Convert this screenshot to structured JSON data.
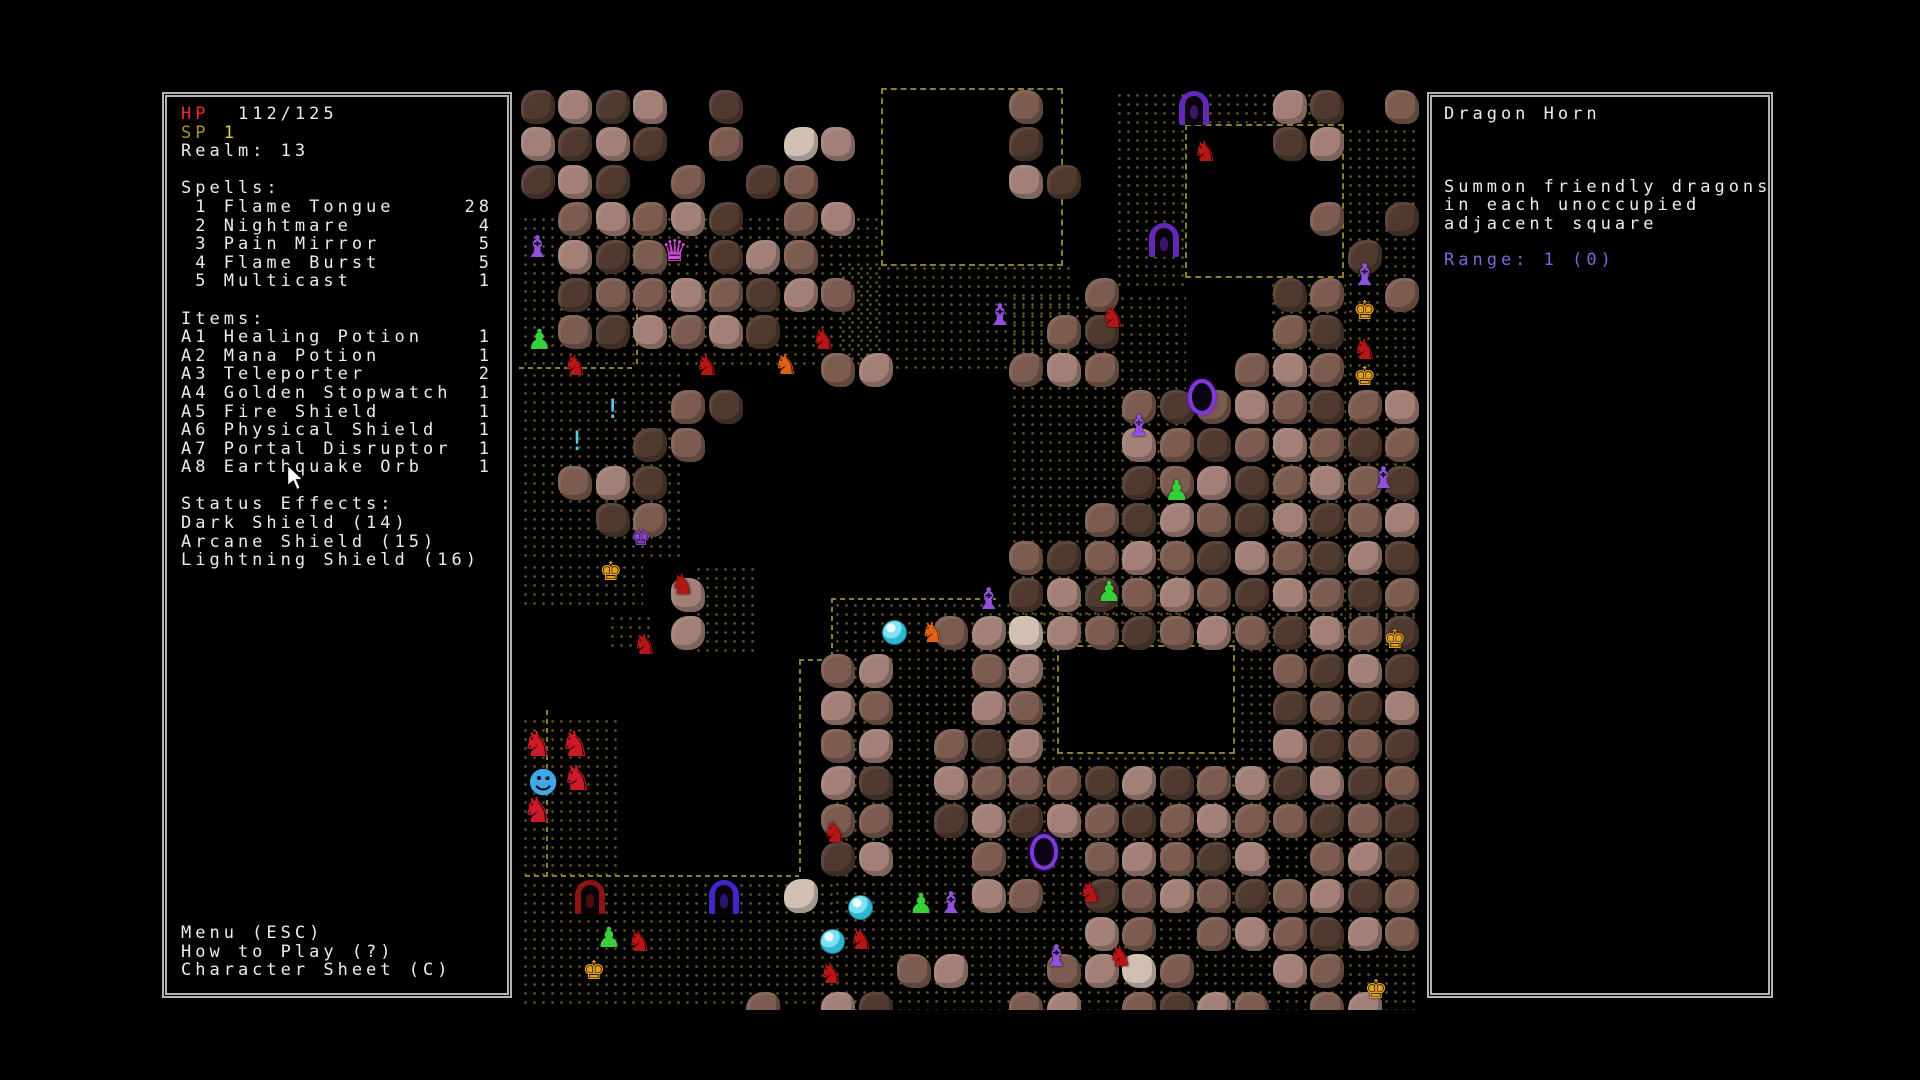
{
  "hud": {
    "hp_label": "HP",
    "hp_value": "112/125",
    "sp_label": "SP",
    "sp_value": "1",
    "realm_label": "Realm:",
    "realm_value": "13",
    "spells_header": "Spells:",
    "spells": [
      {
        "key": "1",
        "name": "Flame Tongue",
        "count": "28"
      },
      {
        "key": "2",
        "name": "Nightmare",
        "count": "4"
      },
      {
        "key": "3",
        "name": "Pain Mirror",
        "count": "5"
      },
      {
        "key": "4",
        "name": "Flame Burst",
        "count": "5"
      },
      {
        "key": "5",
        "name": "Multicast",
        "count": "1"
      }
    ],
    "items_header": "Items:",
    "items": [
      {
        "key": "A1",
        "name": "Healing Potion",
        "count": "1"
      },
      {
        "key": "A2",
        "name": "Mana Potion",
        "count": "1"
      },
      {
        "key": "A3",
        "name": "Teleporter",
        "count": "2"
      },
      {
        "key": "A4",
        "name": "Golden Stopwatch",
        "count": "1"
      },
      {
        "key": "A5",
        "name": "Fire Shield",
        "count": "1"
      },
      {
        "key": "A6",
        "name": "Physical Shield",
        "count": "1"
      },
      {
        "key": "A7",
        "name": "Portal Disruptor",
        "count": "1"
      },
      {
        "key": "A8",
        "name": "Earthquake Orb",
        "count": "1"
      }
    ],
    "status_header": "Status Effects:",
    "status_effects": [
      "Dark Shield (14)",
      "Arcane Shield (15)",
      "Lightning Shield (16)"
    ],
    "menu": [
      "Menu (ESC)",
      "How to Play (?)",
      "Character Sheet (C)"
    ]
  },
  "info_panel": {
    "title": "Dragon Horn",
    "description_lines": [
      "Summon friendly dragons",
      "in each unoccupied",
      "adjacent square"
    ],
    "range_text": "Range: 1 (0)"
  },
  "colors": {
    "hp": "#e83030",
    "sp_label": "#a89a20",
    "sp_value": "#ded040",
    "text": "#ececec",
    "panel_border": "#b4b4b4",
    "range_text": "#7e66d4",
    "floor_dots": "#6f6628",
    "wall_dash": "#8a7f2e"
  },
  "map": {
    "origin_x": 519,
    "origin_y": 88,
    "cell": 37.6,
    "rock_colors": {
      "1": "#503a30",
      "2": "#7c5c50",
      "3": "#a28078",
      "4": "#d0bfb2"
    },
    "grid": [
      "1313 1       2  ... 31 2",
      "3131 2 43    1  ... 13..",
      "131.2 12     31     ....",
      ".23231 23.          .2.1",
      ".312.132..          ..1.",
      ".12232132.. .. 2    12.2",
      ".213231.......21....21..",
      "........23...232...232..",
      "....21       ...21232123",
      "...12        ...32123212",
      ".231         ...12312321",
      "..12         ..213213123",
      ".....       .21232132131",
      "....3       .13123213212",
      "....3   ...2343212321321",
      "        23..23      2131",
      "..      32..32      1213",
      "..      23.213      3121",
      "..      31.3222131231312",
      "..      22.1313212322121",
      ".....   13..2..23213.231",
      ".  .. .4....32.123212312",
      "...............32.232132",
      "..........23..2342..32..",
      "......2.31...23.2132.23."
    ],
    "floors": [
      [
        0,
        3.3,
        9.6,
        4.15
      ],
      [
        0,
        7.45,
        4.4,
        5.1
      ],
      [
        0,
        12.55,
        3.3,
        1.2
      ],
      [
        2.3,
        13.9,
        1.3,
        1.1
      ],
      [
        0,
        16.65,
        2.6,
        4.35
      ],
      [
        8.45,
        4.6,
        6.3,
        2.9
      ],
      [
        13,
        5.4,
        4.75,
        9.4
      ],
      [
        15.8,
        0,
        1.95,
        5.4
      ],
      [
        17.75,
        0,
        4.2,
        0.93
      ],
      [
        21.95,
        0.95,
        1.9,
        13.9
      ],
      [
        19.9,
        5.05,
        2.1,
        9.8
      ],
      [
        8.3,
        13.57,
        15.55,
        10.95
      ],
      [
        0,
        21,
        8.35,
        3.5
      ],
      [
        4.6,
        12.6,
        1.75,
        2.55
      ]
    ],
    "rooms": [
      [
        9.62,
        0,
        4.85,
        4.72
      ],
      [
        17.7,
        0.95,
        4.25,
        4.1
      ],
      [
        14.3,
        14.8,
        4.75,
        2.9
      ]
    ],
    "walls": [
      {
        "o": "h",
        "x": 0.15,
        "y": 20.93,
        "len": 7.3
      },
      {
        "o": "v",
        "x": 7.45,
        "y": 15.2,
        "len": 5.75
      },
      {
        "o": "h",
        "x": 7.45,
        "y": 15.18,
        "len": 0.9
      },
      {
        "o": "v",
        "x": 8.3,
        "y": 13.55,
        "len": 1.7
      },
      {
        "o": "h",
        "x": 8.3,
        "y": 13.55,
        "len": 4.4
      },
      {
        "o": "v",
        "x": 0.72,
        "y": 16.55,
        "len": 4.4
      },
      {
        "o": "h",
        "x": 0.0,
        "y": 7.42,
        "len": 3.1
      },
      {
        "o": "v",
        "x": 3.1,
        "y": 5.3,
        "len": 2.12
      }
    ],
    "doors": [
      {
        "c": 17.55,
        "r": 0.08,
        "kind": "purple"
      },
      {
        "c": 16.75,
        "r": 3.6,
        "kind": "purple"
      },
      {
        "c": 1.5,
        "r": 21.05,
        "kind": "red"
      },
      {
        "c": 5.05,
        "r": 21.05,
        "kind": "indigo"
      }
    ],
    "door_colors": {
      "purple": "#6428b8",
      "red": "#8c1414",
      "indigo": "#4028c8"
    },
    "rings": [
      [
        17.8,
        7.75
      ],
      [
        13.6,
        19.85
      ]
    ],
    "sprites": {
      "witch": {
        "glyph": "♝",
        "color": "#9050e0",
        "size": 30
      },
      "demon": {
        "glyph": "♛",
        "color": "#d848d8",
        "size": 30
      },
      "spider": {
        "glyph": "♟",
        "color": "#38d038",
        "size": 28
      },
      "fox": {
        "glyph": "♞",
        "color": "#b81616",
        "size": 28
      },
      "crab": {
        "glyph": "♞",
        "color": "#e06018",
        "size": 28
      },
      "dragon": {
        "glyph": "♞",
        "color": "#cc1a28",
        "size": 35
      },
      "player": {
        "glyph": "☻",
        "color": "#40a8e8",
        "size": 30
      },
      "imp": {
        "glyph": "♚",
        "color": "#e0a024",
        "size": 26
      },
      "impP": {
        "glyph": "♚",
        "color": "#9048d0",
        "size": 23
      },
      "potion": {
        "glyph": "!",
        "color": "#58c8e8",
        "size": 27
      }
    },
    "entities": [
      {
        "c": 0.0,
        "r": 3.75,
        "t": "witch"
      },
      {
        "c": 3.65,
        "r": 3.85,
        "t": "demon"
      },
      {
        "c": 12.3,
        "r": 5.55,
        "t": "witch"
      },
      {
        "c": 15.3,
        "r": 5.6,
        "t": "fox"
      },
      {
        "c": 17.75,
        "r": 1.2,
        "t": "fox"
      },
      {
        "c": 0.05,
        "r": 6.2,
        "t": "spider"
      },
      {
        "c": 1.0,
        "r": 6.9,
        "t": "fox"
      },
      {
        "c": 4.5,
        "r": 6.9,
        "t": "fox"
      },
      {
        "c": 6.6,
        "r": 6.85,
        "t": "crab"
      },
      {
        "c": 7.6,
        "r": 6.2,
        "t": "fox"
      },
      {
        "c": 2.0,
        "r": 8.05,
        "t": "potion"
      },
      {
        "c": 1.05,
        "r": 8.9,
        "t": "potion"
      },
      {
        "c": 16.0,
        "r": 8.5,
        "t": "witch"
      },
      {
        "c": 17.0,
        "r": 10.2,
        "t": "spider"
      },
      {
        "c": 22.0,
        "r": 4.5,
        "t": "witch"
      },
      {
        "c": 22.0,
        "r": 5.45,
        "t": "imp"
      },
      {
        "c": 22.0,
        "r": 6.45,
        "t": "fox"
      },
      {
        "c": 22.0,
        "r": 7.2,
        "t": "imp"
      },
      {
        "c": 22.5,
        "r": 9.9,
        "t": "witch"
      },
      {
        "c": 2.75,
        "r": 11.5,
        "t": "impP"
      },
      {
        "c": 1.95,
        "r": 12.4,
        "t": "imp"
      },
      {
        "c": 3.85,
        "r": 12.7,
        "t": "fox"
      },
      {
        "c": 12.0,
        "r": 13.1,
        "t": "witch"
      },
      {
        "c": 15.2,
        "r": 12.9,
        "t": "spider"
      },
      {
        "c": 9.5,
        "r": 14.0,
        "t": "bubble"
      },
      {
        "c": 10.5,
        "r": 14.0,
        "t": "crab"
      },
      {
        "c": 2.85,
        "r": 14.3,
        "t": "fox"
      },
      {
        "c": 22.8,
        "r": 14.2,
        "t": "imp"
      },
      {
        "c": 0.0,
        "r": 17.0,
        "t": "dragon"
      },
      {
        "c": 1.0,
        "r": 17.0,
        "t": "dragon"
      },
      {
        "c": 1.05,
        "r": 17.9,
        "t": "dragon"
      },
      {
        "c": 0.0,
        "r": 18.75,
        "t": "dragon"
      },
      {
        "c": 0.15,
        "r": 18.0,
        "t": "player"
      },
      {
        "c": 7.9,
        "r": 19.3,
        "t": "fox"
      },
      {
        "c": 14.7,
        "r": 20.9,
        "t": "fox"
      },
      {
        "c": 8.6,
        "r": 21.3,
        "t": "bubble"
      },
      {
        "c": 10.2,
        "r": 21.2,
        "t": "spider"
      },
      {
        "c": 11.0,
        "r": 21.2,
        "t": "witch"
      },
      {
        "c": 1.9,
        "r": 22.1,
        "t": "spider"
      },
      {
        "c": 2.7,
        "r": 22.2,
        "t": "fox"
      },
      {
        "c": 7.85,
        "r": 22.2,
        "t": "bubble"
      },
      {
        "c": 8.6,
        "r": 22.15,
        "t": "fox"
      },
      {
        "c": 13.8,
        "r": 22.6,
        "t": "witch"
      },
      {
        "c": 15.5,
        "r": 22.6,
        "t": "fox"
      },
      {
        "c": 1.5,
        "r": 23.0,
        "t": "imp"
      },
      {
        "c": 7.8,
        "r": 23.05,
        "t": "fox"
      },
      {
        "c": 22.3,
        "r": 23.5,
        "t": "imp"
      }
    ]
  }
}
